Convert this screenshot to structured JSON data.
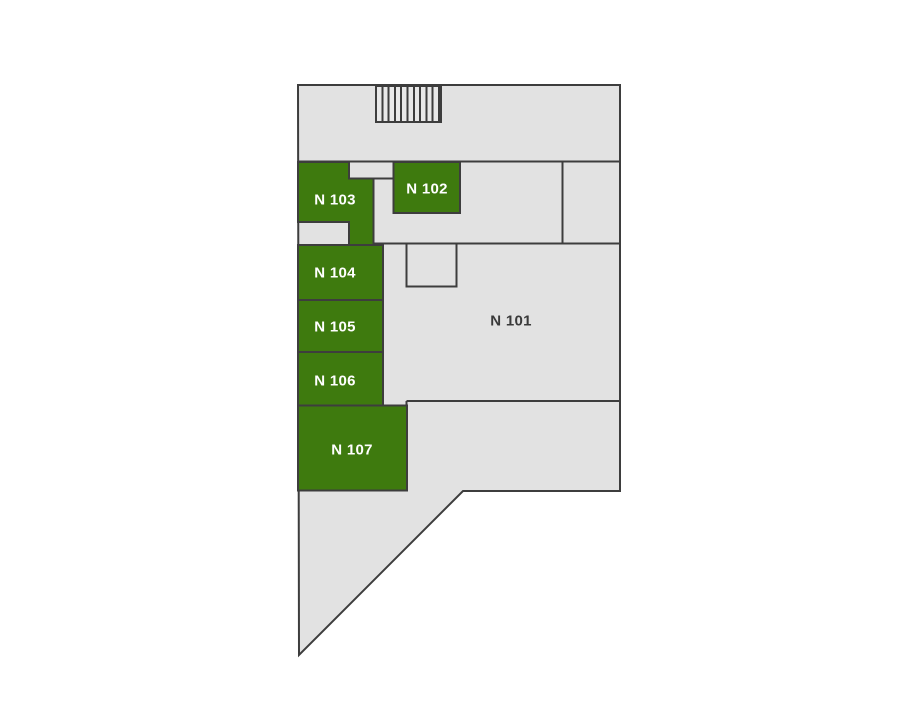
{
  "floorplan": {
    "colors": {
      "page_bg": "#ffffff",
      "building_fill": "#e2e2e2",
      "stairs_fill": "#e8e8e8",
      "wall": "#3d3d3d",
      "room_highlight": "#3e7a0e",
      "label_light": "#ffffff",
      "label_dark": "#3a3a3a"
    },
    "rooms": [
      {
        "id": "n101",
        "label": "N 101",
        "highlighted": false
      },
      {
        "id": "n102",
        "label": "N 102",
        "highlighted": true
      },
      {
        "id": "n103",
        "label": "N 103",
        "highlighted": true
      },
      {
        "id": "n104",
        "label": "N 104",
        "highlighted": true
      },
      {
        "id": "n105",
        "label": "N 105",
        "highlighted": true
      },
      {
        "id": "n106",
        "label": "N 106",
        "highlighted": true
      },
      {
        "id": "n107",
        "label": "N 107",
        "highlighted": true
      }
    ],
    "stairs": {
      "label": "stairs",
      "step_count": 11
    }
  }
}
